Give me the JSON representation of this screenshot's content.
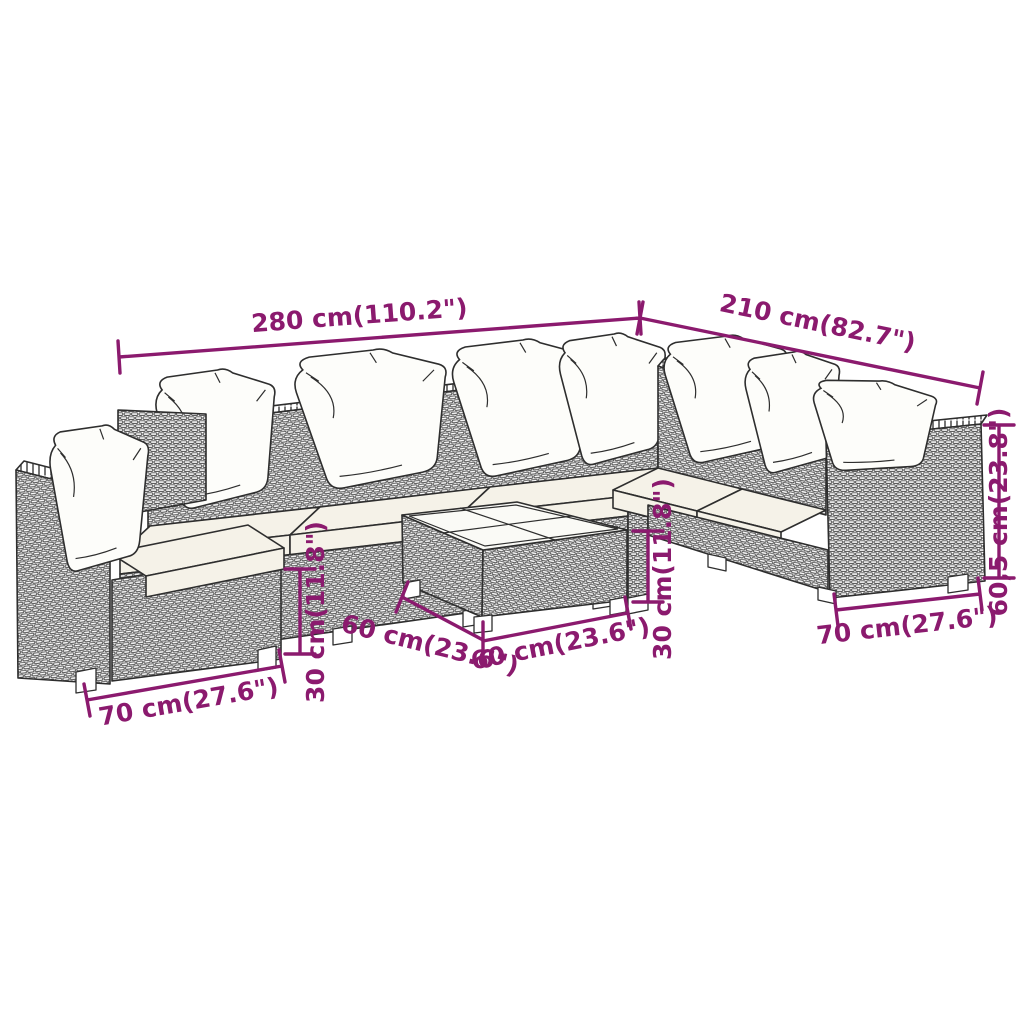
{
  "title": "Garden lounge furniture set dimension diagram",
  "colors": {
    "dimension_color": "#8b1a6e",
    "line_color": "#2e2e2e",
    "cushion_color": "#f5f2e8",
    "background": "#ffffff"
  },
  "annotations": {
    "sofa_long_side": {
      "label": "280 cm(110.2\")"
    },
    "sofa_short_side": {
      "label": "210 cm(82.7\")"
    },
    "back_height": {
      "label": "60,5 cm(23.8\")"
    },
    "module_width_left": {
      "label": "70 cm(27.6\")"
    },
    "module_width_right": {
      "label": "70 cm(27.6\")"
    },
    "seat_height_left": {
      "label": "30 cm(11.8\")"
    },
    "seat_height_center": {
      "label": "30 cm(11.8\")"
    },
    "table_side_left": {
      "label": "60 cm(23.6\")"
    },
    "table_side_right": {
      "label": "60 cm(23.6\")"
    }
  }
}
